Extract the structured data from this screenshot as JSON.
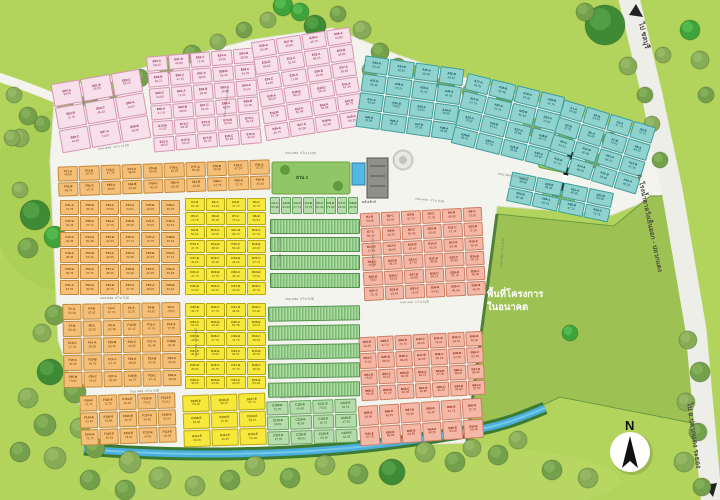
{
  "map": {
    "background_color": "#b2d45c",
    "road_color": "#f4f4ee",
    "canal_color": "#49aedb",
    "future_area_color": "#9dc253",
    "labels": {
      "to_chonburi": "ไป ชลบุรี",
      "highway_name": "ถ. โรงน้ำตาลวังเย็นออก - ปลวกแดง",
      "to_pluak_daeng": "ไป อ.ปลวกแดง ระยอง",
      "future_line1": "พื้นที่โครงการ",
      "future_line2": "ในอนาคต",
      "compass_n": "N",
      "park1": "สวน 1",
      "park2": "สวน 2",
      "clubhouse": "คลับเฮ้าส์",
      "road_w12": "ถนน คสล. กว้าง 12.00",
      "road_w9": "ถนน คสล. กว้าง 9.00"
    },
    "plot_areas_sqwah": [
      62.46,
      54.51,
      71.02,
      50.48,
      45.86,
      40.06,
      39.06,
      43.43,
      45.75,
      46.75,
      39.28,
      47.74,
      64.92,
      47.76,
      60.23,
      72.75,
      52.5,
      48.06,
      56.18,
      45.43,
      58.15,
      63.4,
      67.29,
      73.02,
      44.8,
      40.25
    ],
    "zones": [
      {
        "id": "E",
        "color": "#f8e0ea",
        "border": "#d795b2",
        "text": "#8d2b50",
        "suffixes": [
          "A",
          "B",
          "C"
        ],
        "blocks": [
          {
            "ref": "e-left",
            "start": 80
          },
          {
            "ref": "e-a",
            "start": 50
          },
          {
            "ref": "e-b",
            "start": 26
          }
        ]
      },
      {
        "id": "A",
        "color": "#8fd2ce",
        "border": "#3f9e98",
        "text": "#0a4f5c",
        "suffixes": [
          "A",
          "B"
        ],
        "blocks": [
          {
            "ref": "a-1",
            "start": 33
          },
          {
            "ref": "a-2",
            "start": 17
          },
          {
            "ref": "a-3",
            "start": 1
          },
          {
            "ref": "a-sub",
            "start": 49
          }
        ]
      },
      {
        "id": "F",
        "color": "#f4c078",
        "border": "#c4893a",
        "text": "#7c3d05",
        "suffixes": [
          "A",
          "B",
          "C"
        ],
        "blocks": [
          {
            "ref": "f-top",
            "start": 71
          },
          {
            "ref": "f-mid",
            "start": 31
          },
          {
            "ref": "f-low",
            "start": 1
          },
          {
            "ref": "f-bot",
            "start": 99,
            "suffix": "E"
          }
        ]
      },
      {
        "id": "D",
        "color": "#f6e93c",
        "border": "#b9a714",
        "text": "#6b5504",
        "suffixes": [
          "B",
          "C"
        ],
        "blocks": [
          {
            "ref": "d-top",
            "start": 1
          },
          {
            "ref": "d-mid",
            "start": 29
          },
          {
            "ref": "d-bot",
            "start": 105,
            "suffix": "E"
          }
        ]
      },
      {
        "id": "C",
        "color": "#b7dcab",
        "border": "#67a55e",
        "text": "#2c5e20",
        "suffixes": [
          "C",
          "B"
        ],
        "blocks": [
          {
            "ref": "c-top",
            "start": 1
          },
          {
            "ref": "c-bot",
            "start": 109,
            "suffix": "E"
          }
        ]
      },
      {
        "id": "B",
        "color": "#f5b8a6",
        "border": "#cd7e64",
        "text": "#872812",
        "suffixes": [
          "B",
          "C"
        ],
        "blocks": [
          {
            "ref": "b-top",
            "start": 1
          },
          {
            "ref": "b-mid",
            "start": 37
          },
          {
            "ref": "b-bot",
            "start": 85,
            "suffix": "E"
          }
        ]
      }
    ]
  }
}
